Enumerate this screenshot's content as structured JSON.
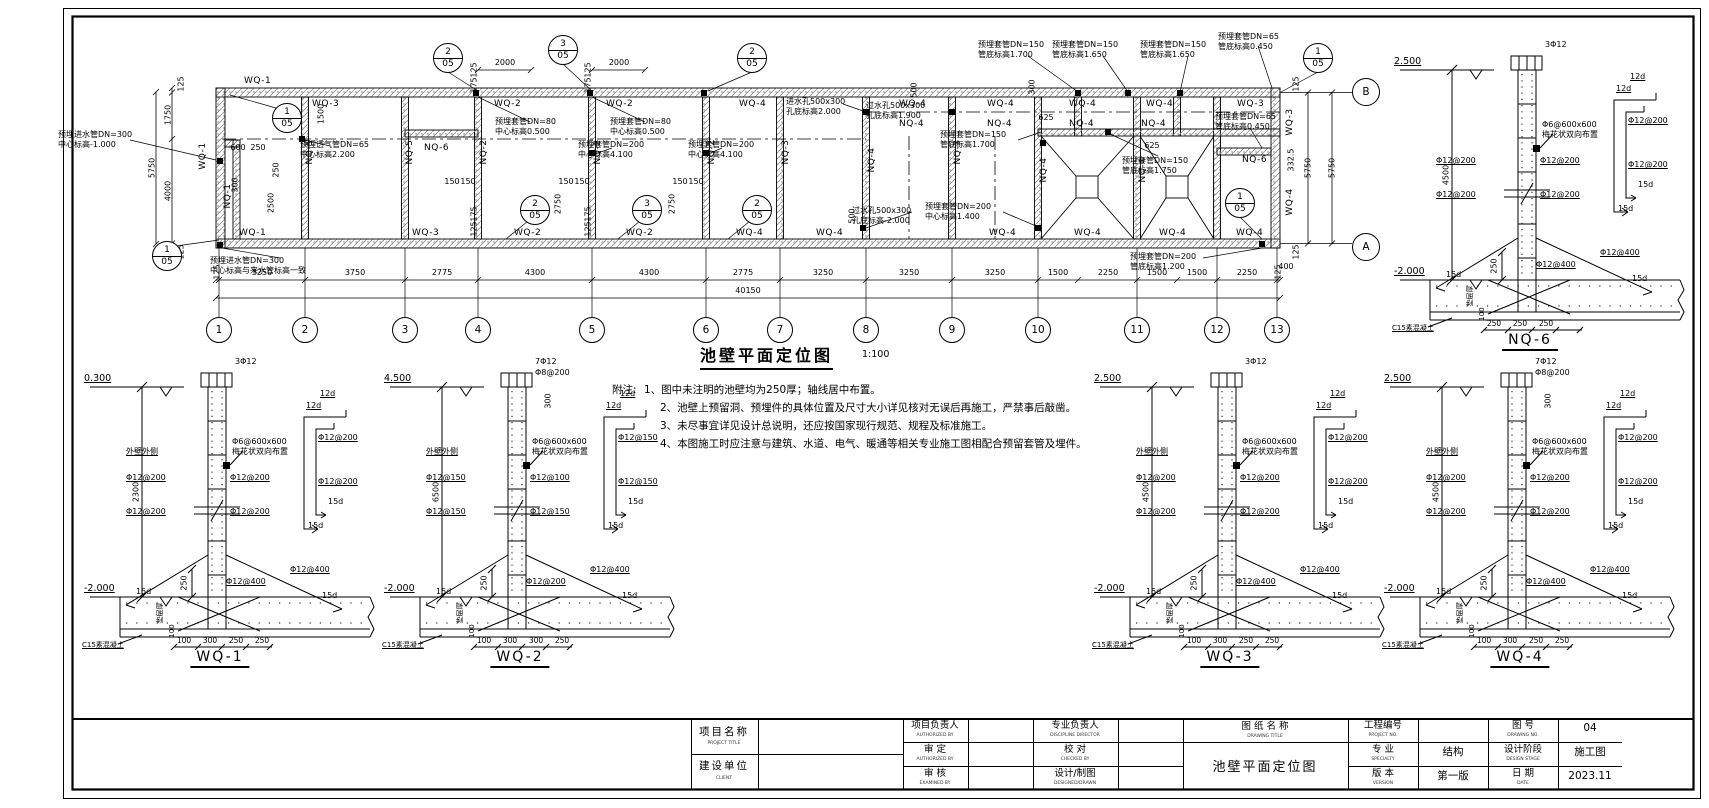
{
  "sheet": {
    "title_block": {
      "project_title_label": "项目名称",
      "project_title_sub": "PROJECT TITLE",
      "client_label": "建设单位",
      "client_sub": "CLIENT",
      "pm_label": "项目负责人",
      "pm_sub": "AUTHORIZED BY",
      "approve_label": "审  定",
      "approve_sub": "AUTHORIZED BY",
      "examine_label": "审  核",
      "examine_sub": "EXAMINED BY",
      "lead_label": "专业负责人",
      "lead_sub": "DISCIPLINE DIRECTOR",
      "check_label": "校  对",
      "check_sub": "CHECKED BY",
      "design_label": "设计/制图",
      "design_sub": "DESIGNED/DRAWN",
      "drawing_title_label": "图 纸 名 称",
      "drawing_title_sub": "DRAWING TITLE",
      "drawing_title_value": "池壁平面定位图",
      "project_no_label": "工程编号",
      "project_no_sub": "PROJECT NO.",
      "project_no_value": "",
      "drawing_no_label": "图  号",
      "drawing_no_sub": "DRAWING NO.",
      "drawing_no_value": "04",
      "specialty_label": "专  业",
      "specialty_sub": "SPECIALTY",
      "specialty_value": "结构",
      "stage_label": "设计阶段",
      "stage_sub": "DESIGN STAGE",
      "stage_value": "施工图",
      "version_label": "版  本",
      "version_sub": "VERSION",
      "version_value": "第一版",
      "date_label": "日  期",
      "date_sub": "DATE",
      "date_value": "2023.11"
    }
  },
  "plan": {
    "title": "池壁平面定位图",
    "scale": "1:100",
    "note_title": "附注:",
    "notes": [
      "1、图中未注明的池壁均为250厚；轴线居中布置。",
      "2、池壁上预留洞、预埋件的具体位置及尺寸大小详见核对无误后再施工，严禁事后敲凿。",
      "3、未尽事宜详见设计总说明，还应按国家现行规范、规程及标准施工。",
      "4、本图施工时应注意与建筑、水道、电气、暖通等相关专业施工图相配合预留套管及埋件。"
    ],
    "grid_cols": [
      "1",
      "2",
      "3",
      "4",
      "5",
      "6",
      "7",
      "8",
      "9",
      "10",
      "11",
      "12",
      "13"
    ],
    "grid_rows": {
      "a": "A",
      "b": "B"
    },
    "dims_bottom": [
      "125",
      "3250",
      "3750",
      "2775",
      "4300",
      "4300",
      "2775",
      "3250",
      "3250",
      "3250",
      "1500",
      "2250",
      "1500",
      "1500",
      "2250",
      "125"
    ],
    "dim_total": "40150",
    "dims_left": [
      "125",
      "1750",
      "4000",
      "125"
    ],
    "dim_left_total": "5750",
    "dims_right": [
      "125",
      "5750",
      "5750",
      "125"
    ],
    "dims_top": [
      "2000",
      "2000"
    ],
    "d": {
      "d600": "600",
      "d250": "250",
      "d300": "300",
      "d2500": "2500",
      "d1500": "1500",
      "d150": "150",
      "d2750": "2750",
      "d625": "625",
      "d500": "500",
      "d3325": "332.5",
      "d400": "400",
      "d125": "125",
      "d175": "175"
    },
    "tags": {
      "wq1": "WQ-1",
      "wq2": "WQ-2",
      "wq3": "WQ-3",
      "wq4": "WQ-4",
      "nq1": "NQ-1",
      "nq2": "NQ-2",
      "nq3": "NQ-3",
      "nq4": "NQ-4",
      "nq5": "NQ-5",
      "nq6": "NQ-6"
    },
    "ann": {
      "a1": "预埋进水管DN=300\n中心标高-1.000",
      "a2": "预埋进水管DN=300\n中心标高与来水管标高一致",
      "a3": "预埋透气管DN=65\n中心标高2.200",
      "a4": "预埋套管DN=80\n中心标高0.500",
      "a5": "预埋套管DN=200\n中心标高4.100",
      "a6": "进水孔500x300\n孔底标高2.000",
      "a7": "过水孔500x300\n孔底标高1.900",
      "a8": "过水孔500x300\n孔底标高-2.000",
      "a9": "预埋套管DN=150\n管底标高1.700",
      "a10": "预埋套管DN=150\n管底标高1.650",
      "a11": "预埋套管DN=65\n管底标高0.450",
      "a12": "预埋套管DN=150\n管底标高1.750",
      "a13": "预埋套管DN=200\n中心标高1.400",
      "a14": "预埋套管DN=200\n管底标高1.200"
    },
    "callout_num": {
      "n1": "1",
      "n2": "2",
      "n3": "3"
    },
    "callout_sheet": "05"
  },
  "details": {
    "wq1": {
      "title": "WQ-1",
      "elev_top": "0.300",
      "elev_bot": "-2.000",
      "height": "2300",
      "bars": "3Φ12",
      "face": "外壁外侧",
      "mesh": "Φ6@600x600\n梅花状双向布置",
      "left": [
        "Φ12@200",
        "Φ12@200"
      ],
      "right": [
        "Φ12@200",
        "Φ12@200"
      ],
      "far": [
        "Φ12@200",
        "Φ12@200"
      ],
      "diag": [
        "Φ12@400",
        "Φ12@400"
      ],
      "hook_t": "12d",
      "hook_b": "15d",
      "dim250": "250",
      "pad": "垫层厚",
      "pad_h": "100",
      "c15": "C15素混凝土",
      "bottom": [
        "100",
        "300",
        "250",
        "250"
      ]
    },
    "wq2": {
      "title": "WQ-2",
      "elev_top": "4.500",
      "elev_bot": "-2.000",
      "height": "6500",
      "bars": "7Φ12",
      "stirrup": "Φ8@200",
      "dim300": "300",
      "face": "外壁外侧",
      "mesh": "Φ6@600x600\n梅花状双向布置",
      "left": [
        "Φ12@150",
        "Φ12@150"
      ],
      "right": [
        "Φ12@100",
        "Φ12@150"
      ],
      "far": [
        "Φ12@150",
        "Φ12@150"
      ],
      "diag": [
        "Φ12@200",
        "Φ12@400"
      ],
      "hook_t": "12d",
      "hook_b": "15d",
      "dim250": "250",
      "pad": "垫层厚",
      "pad_h": "100",
      "c15": "C15素混凝土",
      "bottom": [
        "100",
        "300",
        "300",
        "250"
      ]
    },
    "wq3": {
      "title": "WQ-3",
      "elev_top": "2.500",
      "elev_bot": "-2.000",
      "height": "4500",
      "bars": "3Φ12",
      "face": "外壁外侧",
      "mesh": "Φ6@600x600\n梅花状双向布置",
      "left": [
        "Φ12@200",
        "Φ12@200"
      ],
      "right": [
        "Φ12@200",
        "Φ12@200"
      ],
      "far": [
        "Φ12@200",
        "Φ12@200"
      ],
      "diag": [
        "Φ12@400",
        "Φ12@400"
      ],
      "hook_t": "12d",
      "hook_b": "15d",
      "dim250": "250",
      "pad": "垫层厚",
      "pad_h": "100",
      "c15": "C15素混凝土",
      "bottom": [
        "100",
        "300",
        "250",
        "250"
      ]
    },
    "wq4": {
      "title": "WQ-4",
      "elev_top": "2.500",
      "elev_bot": "-2.000",
      "height": "4500",
      "bars": "7Φ12",
      "stirrup": "Φ8@200",
      "dim300": "300",
      "face": "外壁外侧",
      "mesh": "Φ6@600x600\n梅花状双向布置",
      "left": [
        "Φ12@200",
        "Φ12@200"
      ],
      "right": [
        "Φ12@200",
        "Φ12@200"
      ],
      "far": [
        "Φ12@200",
        "Φ12@200"
      ],
      "diag": [
        "Φ12@400",
        "Φ12@400"
      ],
      "hook_t": "12d",
      "hook_b": "15d",
      "dim250": "250",
      "pad": "垫层厚",
      "pad_h": "100",
      "c15": "C15素混凝土",
      "bottom": [
        "100",
        "300",
        "250",
        "250"
      ]
    },
    "nq6": {
      "title": "NQ-6",
      "elev_top": "2.500",
      "elev_bot": "-2.000",
      "height": "4500",
      "bars": "3Φ12",
      "mesh": "Φ6@600x600\n梅花状双向布置",
      "left": [
        "Φ12@200",
        "Φ12@200"
      ],
      "right": [
        "Φ12@200",
        "Φ12@200"
      ],
      "far": [
        "Φ12@200",
        "Φ12@200"
      ],
      "diag": [
        "Φ12@400",
        "Φ12@400"
      ],
      "hook_t": "12d",
      "hook_b": "15d",
      "dim250": "250",
      "pad": "垫层厚",
      "pad_h": "100",
      "c15": "C15素混凝土",
      "bottom": [
        "250",
        "250",
        "250"
      ]
    }
  }
}
